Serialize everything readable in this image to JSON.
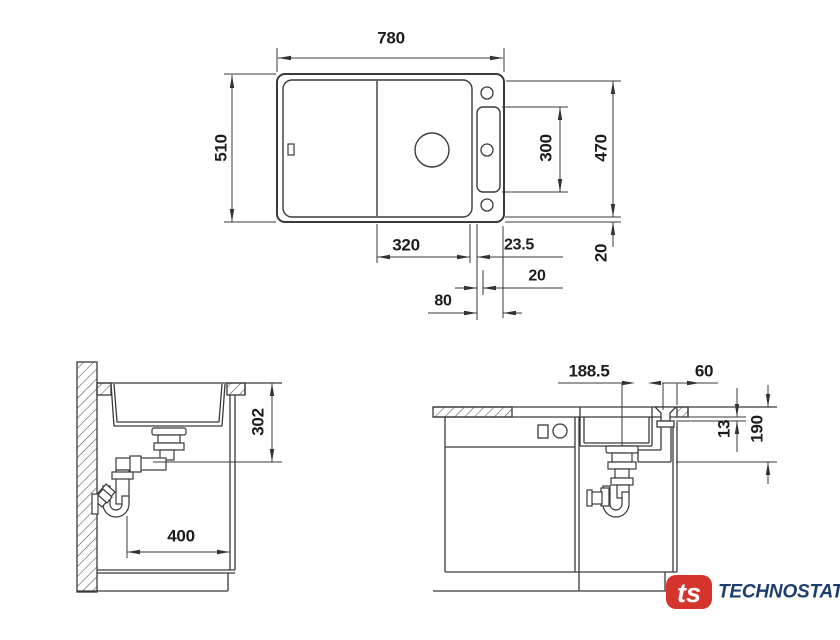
{
  "meta": {
    "background": "#ffffff",
    "line_color": "#3a3a3a",
    "text_color": "#1c1c1c",
    "drawing_type": "sink installation dimensional drawing"
  },
  "logo": {
    "mark_text": "ts",
    "brand_text": "TECHNOSTATUS",
    "mark_color": "#d5342c",
    "brand_color": "#1e3f6d"
  },
  "views": {
    "top_view": {
      "label": "sink top view",
      "dimensions": {
        "overall_width": "780",
        "overall_depth": "510",
        "right_depth": "470",
        "tap_panel_span": "300",
        "bowl_width": "320",
        "bowl_to_panel": "23.5",
        "panel_offset": "20",
        "panel_to_edge": "80",
        "rim_offset": "20"
      }
    },
    "side_view": {
      "label": "side section through cabinet",
      "dimensions": {
        "drain_depth": "302",
        "trap_offset": "400"
      }
    },
    "front_view": {
      "label": "front section through cabinet",
      "dimensions": {
        "drain_offset": "188.5",
        "overflow_offset": "60",
        "worktop_thickness": "13",
        "drain_drop": "190"
      }
    }
  }
}
